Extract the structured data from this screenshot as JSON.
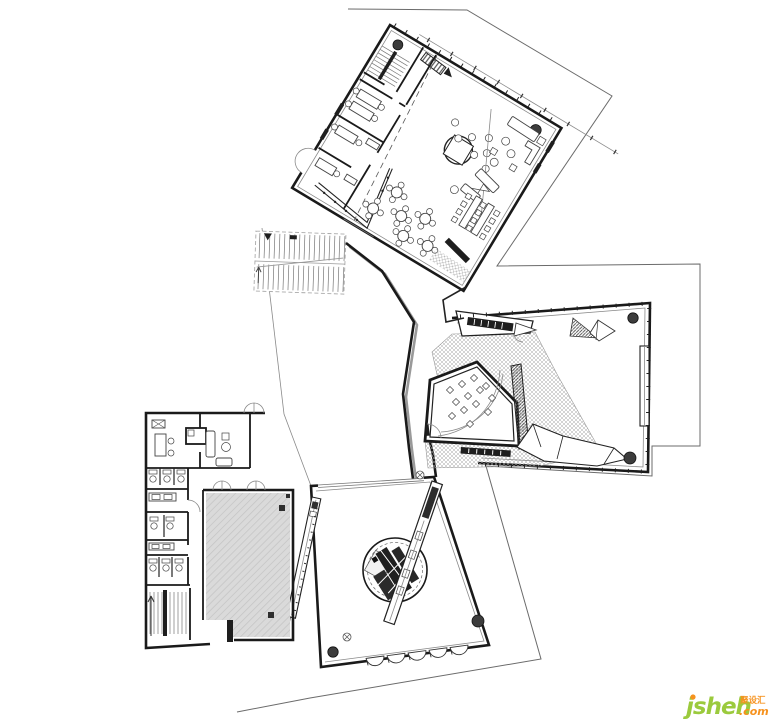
{
  "watermark": {
    "brand": "jsheh",
    "tld": ".com",
    "cjk": "聚设汇"
  },
  "colors": {
    "ink": "#1a1a1a",
    "boundary": "#6b6b6b",
    "hall": "#dadada",
    "shadow": "#9a9a9a",
    "column": "#3c3c3c",
    "brand": "#9bca3d",
    "accent": "#f6921e",
    "paper": "#ffffff"
  }
}
